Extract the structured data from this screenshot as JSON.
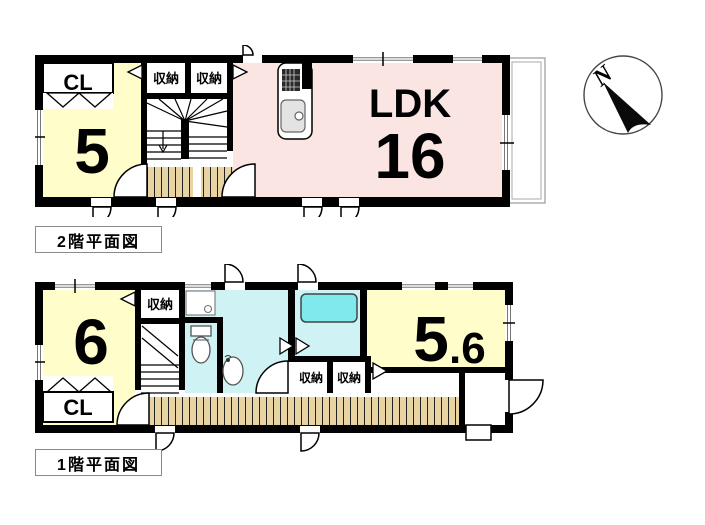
{
  "colors": {
    "wall": "#000000",
    "room_yellow": "#FFFDC9",
    "ldk_pink": "#FBE5E3",
    "wet_cyan": "#CFF3F5",
    "tub_cyan": "#7FE9EE",
    "wood_floor": "#E7D4A2",
    "fixture_gray": "#E3E3E3"
  },
  "floor2": {
    "caption": "2階平面図",
    "closet_label": "CL",
    "room5_size": "5",
    "storage_left": "収納",
    "storage_right": "収納",
    "ldk_name": "LDK",
    "ldk_size": "16"
  },
  "floor1": {
    "caption": "1階平面図",
    "room6_size": "6",
    "closet_label": "CL",
    "storage_top": "収納",
    "storage_hall_left": "収納",
    "storage_hall_right": "収納",
    "room56_size_main": "5",
    "room56_size_decimal": ".6"
  },
  "compass": {
    "north_label": "N"
  }
}
